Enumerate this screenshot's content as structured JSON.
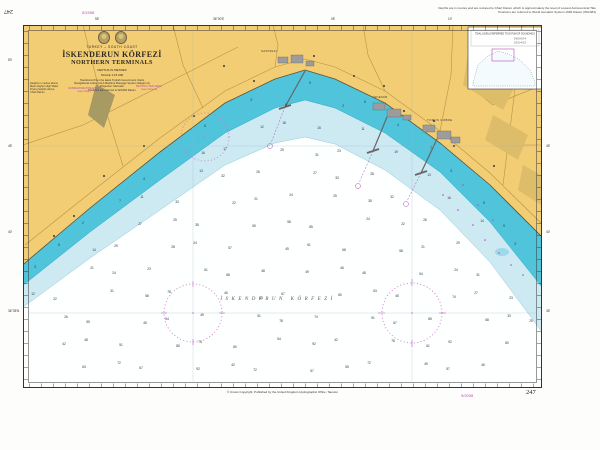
{
  "chart": {
    "number": "247",
    "title_block": {
      "country": "TURKEY – SOUTH COAST",
      "title": "İSKENDERUN KÖRFEZİ",
      "subtitle": "NORTHERN TERMINALS",
      "depths_note": "DEPTHS IN METRES",
      "scale_note": "SCALE 1:15 000",
      "notes": [
        "Transferred from the latest Turkish Government charts",
        "Navigational marks: IALA Maritime Buoyage System (Region A)",
        "Projection: Mercator",
        "Positions are referred to WGS84 Datum"
      ]
    },
    "land_notes": {
      "black_block": [
        "Heights in metres above",
        "Mean Higher High Water",
        "Drying heights above",
        "Chart Datum"
      ],
      "magenta_note_1": [
        "SUBMARINE PIPELINES",
        "(see Note)"
      ],
      "magenta_note_2": [
        "RESTRICTED AREA",
        "(see Note 2)"
      ]
    },
    "terminal_labels": {
      "t1": "SARISEKİ",
      "t2": "İSDEMİR",
      "t3": "TOROS GÜBRE"
    },
    "sea_label": "İSKENDERUN KÖRFEZİ",
    "inset": {
      "title": "TIDAL LEVELS REFERRED TO DATUM OF SOUNDINGS",
      "row1": "0·8  0·6  0·4",
      "row2": "0·5  0·4  0·2"
    }
  },
  "margins": {
    "top_corner_number": "247",
    "top_stamp": "5/1998",
    "notice_line1": "Depths are in metres and are reduced to Chart Datum which is approximately the level of Lowest Astronomical Tide",
    "notice_line2": "Positions are referred to World Geodetic System 1984 Datum (WGS84)",
    "bottom_line": "© Crown Copyright. Published by the United Kingdom Hydrographic Office, Taunton",
    "bottom_stamp": "9/2008",
    "bottom_corner_number": "247"
  },
  "border_ticks": {
    "top": [
      {
        "x": 95,
        "label": "55'"
      },
      {
        "x": 213,
        "label": "36°00'E"
      },
      {
        "x": 331,
        "label": "05'"
      },
      {
        "x": 448,
        "label": "10'"
      }
    ],
    "left": [
      {
        "y": 58,
        "label": "50'"
      },
      {
        "y": 144,
        "label": "45'"
      },
      {
        "y": 230,
        "label": "40'"
      },
      {
        "y": 309,
        "label": "36°35'N"
      }
    ],
    "right": [
      {
        "y": 144,
        "label": "45'"
      },
      {
        "y": 230,
        "label": "40'"
      },
      {
        "y": 309,
        "label": "35'"
      }
    ]
  },
  "colors": {
    "land": "#f3cd74",
    "builtup": "#a89a63",
    "shallow_water": "#4fc4db",
    "shoal_band": "#cdeaf3",
    "deep_water": "#feffff",
    "magenta": "#b34fb3",
    "terminal_gray": "#9c9c9c"
  },
  "boundaries": {
    "coast": [
      [
        0,
        240
      ],
      [
        3,
        237
      ],
      [
        67,
        183
      ],
      [
        137,
        127
      ],
      [
        202,
        78
      ],
      [
        252,
        54
      ],
      [
        282,
        45
      ],
      [
        312,
        54
      ],
      [
        362,
        78
      ],
      [
        417,
        118
      ],
      [
        467,
        160
      ],
      [
        519,
        212
      ]
    ],
    "cyan_outer": [
      [
        0,
        260
      ],
      [
        3,
        258
      ],
      [
        67,
        207
      ],
      [
        137,
        155
      ],
      [
        202,
        108
      ],
      [
        252,
        83
      ],
      [
        282,
        75
      ],
      [
        312,
        83
      ],
      [
        362,
        108
      ],
      [
        417,
        147
      ],
      [
        467,
        197
      ],
      [
        519,
        262
      ]
    ],
    "pale_outer": [
      [
        0,
        282
      ],
      [
        3,
        280
      ],
      [
        67,
        233
      ],
      [
        137,
        185
      ],
      [
        202,
        140
      ],
      [
        252,
        118
      ],
      [
        282,
        112
      ],
      [
        312,
        119
      ],
      [
        362,
        145
      ],
      [
        417,
        185
      ],
      [
        467,
        237
      ],
      [
        519,
        307
      ]
    ]
  },
  "soundings": {
    "cyan": [
      3,
      5,
      2,
      7,
      4,
      6,
      3,
      8,
      5,
      2,
      6,
      4,
      7,
      3,
      5,
      9
    ],
    "pale": [
      12,
      14,
      11,
      16,
      13,
      17,
      12,
      18,
      15,
      11,
      19,
      13,
      16,
      14
    ],
    "white_shallow": [
      22,
      26,
      21,
      29,
      24,
      31,
      27,
      23,
      33,
      25,
      28,
      35,
      24,
      32
    ],
    "white_deep": [
      42,
      55,
      48,
      63,
      51,
      72,
      58,
      45,
      67,
      78,
      54,
      85,
      61,
      49,
      74,
      92,
      57,
      68,
      46,
      80
    ]
  }
}
